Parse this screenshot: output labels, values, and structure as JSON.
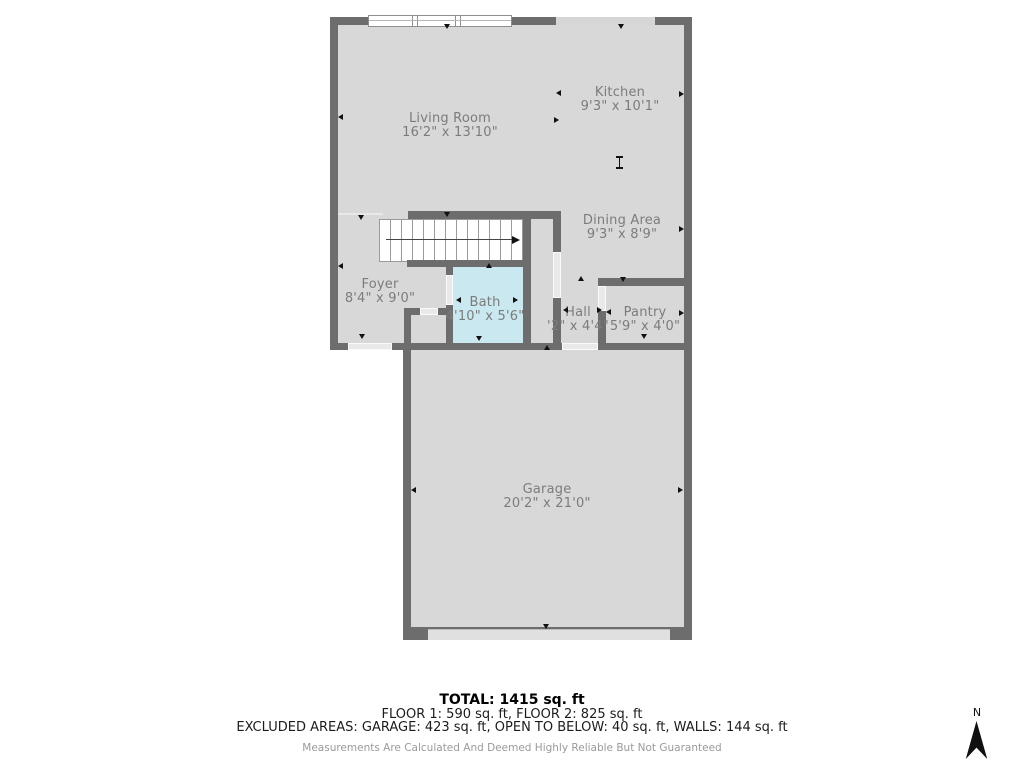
{
  "plan": {
    "rooms": [
      {
        "name": "Living Room",
        "dims": "16'2\" x 13'10\""
      },
      {
        "name": "Kitchen",
        "dims": "9'3\" x 10'1\""
      },
      {
        "name": "Dining Area",
        "dims": "9'3\" x 8'9\""
      },
      {
        "name": "Foyer",
        "dims": "8'4\" x 9'0\""
      },
      {
        "name": "Bath",
        "dims": "4'10\" x 5'6\""
      },
      {
        "name": "Hall",
        "dims": "'2\" x 4'4\""
      },
      {
        "name": "Pantry",
        "dims": "5'9\" x 4'0\""
      },
      {
        "name": "Garage",
        "dims": "20'2\" x 21'0\""
      }
    ],
    "colors": {
      "wall": "#6d6d6d",
      "floor_fill": "#d8d8d8",
      "bath_fill": "#c9e8f0",
      "label_text": "#7c7c7c"
    },
    "icons": {
      "dimension_marker": "small black arrowhead",
      "stair_direction": "right arrow",
      "compass": "north needle"
    }
  },
  "summary": {
    "total": "TOTAL: 1415 sq. ft",
    "floors": "FLOOR 1: 590 sq. ft, FLOOR 2: 825 sq. ft",
    "excluded": "EXCLUDED AREAS: GARAGE: 423 sq. ft, OPEN TO BELOW: 40 sq. ft, WALLS: 144 sq. ft",
    "disclaimer": "Measurements Are Calculated And Deemed Highly Reliable But Not Guaranteed"
  },
  "compass": {
    "label": "N"
  }
}
